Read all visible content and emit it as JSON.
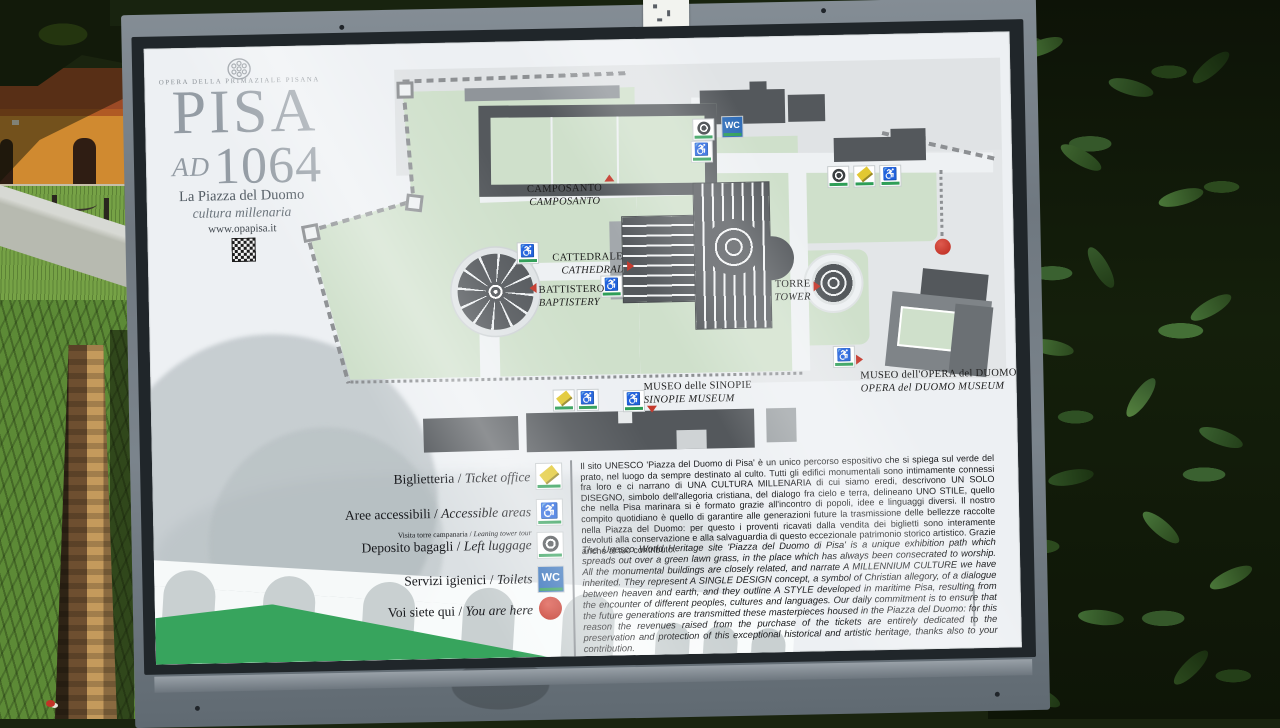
{
  "header": {
    "publisher": "OPERA DELLA PRIMAZIALE PISANA",
    "title": "PISA",
    "ad": "AD",
    "year": "1064",
    "subtitle": "La Piazza del Duomo",
    "subtitle2": "cultura millenaria",
    "website": "www.opapisa.it"
  },
  "icons": {
    "wc": "WC"
  },
  "map": {
    "camposanto": {
      "it": "CAMPOSANTO",
      "en": "CAMPOSANTO"
    },
    "cattedrale": {
      "it": "CATTEDRALE",
      "en": "CATHEDRAL"
    },
    "battistero": {
      "it": "BATTISTERO",
      "en": "BAPTISTERY"
    },
    "torre": {
      "it": "TORRE",
      "en": "TOWER"
    },
    "sinopie": {
      "it": "MUSEO delle SINOPIE",
      "en": "SINOPIE MUSEUM"
    },
    "opera": {
      "it": "MUSEO dell'OPERA del DUOMO",
      "en": "OPERA del DUOMO MUSEUM"
    }
  },
  "legend": {
    "separator": "/",
    "items": [
      {
        "it": "Biglietteria",
        "en": "Ticket office"
      },
      {
        "it": "Aree accessibili",
        "en": "Accessible areas"
      },
      {
        "small_it": "Visita torre campanaria",
        "small_en": "Leaning tower tour",
        "it": "Deposito bagagli",
        "en": "Left luggage"
      },
      {
        "it": "Servizi igienici",
        "en": "Toilets"
      },
      {
        "it": "Voi siete qui",
        "en": "You are here"
      }
    ]
  },
  "texts": {
    "italian": "Il sito UNESCO 'Piazza del Duomo di Pisa' è un unico percorso espositivo che si spiega sul verde del prato, nel luogo da sempre destinato al culto. Tutti gli edifici monumentali sono intimamente connessi fra loro e ci narrano di UNA CULTURA MILLENARIA di cui siamo eredi, descrivono UN SOLO DISEGNO, simbolo dell'allegoria cristiana, del dialogo fra cielo e terra, delineano UNO STILE, quello che nella Pisa marinara si è formato grazie all'incontro di popoli, idee e linguaggi diversi. Il nostro compito quotidiano è quello di garantire alle generazioni future la trasmissione delle bellezze raccolte nella Piazza del Duomo: per questo i proventi ricavati dalla vendita dei biglietti sono interamente devoluti alla conservazione e alla salvaguardia di questo eccezionale patrimonio storico artistico. Grazie anche al tuo contributo.",
    "english": "The Unesco World Heritage site 'Piazza del Duomo di Pisa' is a unique exhibition path which spreads out over a green lawn grass, in the place which has always been consecrated to worship. All the monumental buildings are closely related, and narrate A MILLENNIUM CULTURE we have inherited. They represent A SINGLE DESIGN concept, a symbol of Christian allegory, of a dialogue between heaven and earth, and they outline A STYLE developed in maritime Pisa, resulting from the encounter of different peoples, cultures and languages. Our daily commitment is to ensure that the future generations are transmitted these masterpieces housed in the Piazza del Duomo: for this reason the revenues raised from the purchase of the tickets are entirely dedicated to the preservation and protection of this exceptional historical and artistic heritage, thanks also to your contribution."
  },
  "colors": {
    "lawn": "#cfe0cb",
    "building_dark": "#54585c",
    "accent_green": "#2f9e57",
    "band_green": "#37a45d",
    "wc_blue": "#2e6cb8",
    "marker_red": "#c53a2e",
    "ticket_yellow": "#e2c832",
    "frame_metal": "#7b848c"
  }
}
